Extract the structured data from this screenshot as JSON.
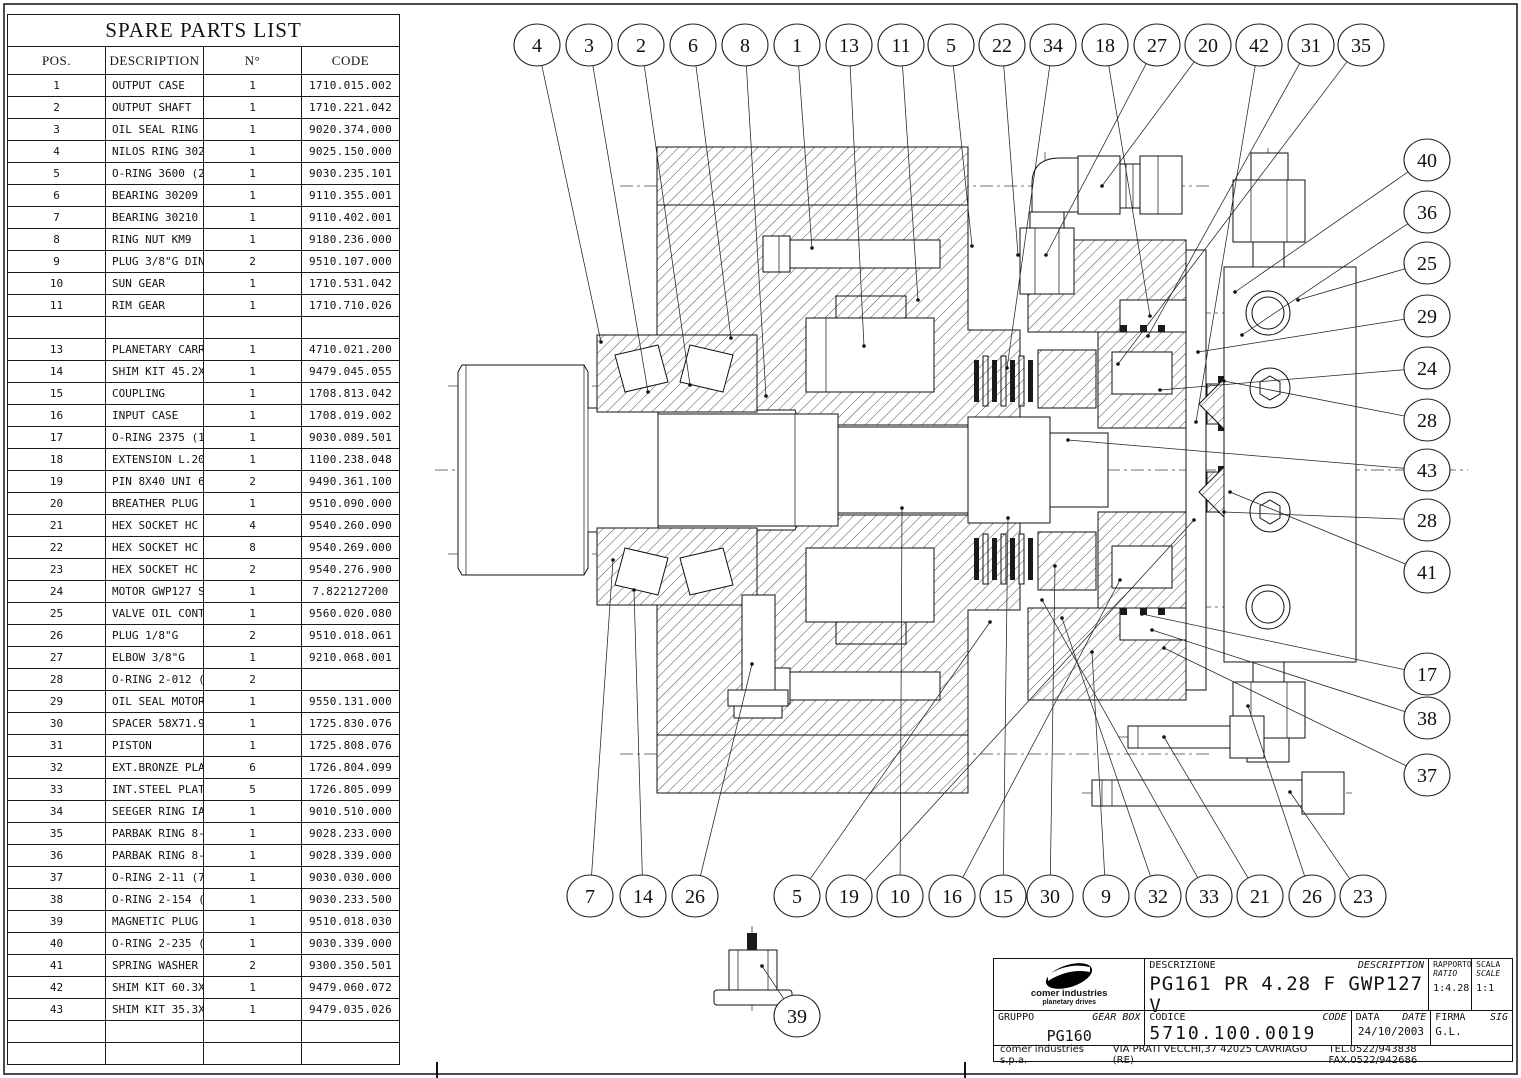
{
  "table": {
    "title": "SPARE PARTS LIST",
    "columns": [
      "POS.",
      "DESCRIPTION",
      "N°",
      "CODE"
    ],
    "rows": [
      {
        "pos": "1",
        "desc": "OUTPUT CASE",
        "qty": "1",
        "code": "1710.015.002"
      },
      {
        "pos": "2",
        "desc": "OUTPUT SHAFT",
        "qty": "1",
        "code": "1710.221.042"
      },
      {
        "pos": "3",
        "desc": "OIL SEAL RING 50X72X8 BA",
        "qty": "1",
        "code": "9020.374.000"
      },
      {
        "pos": "4",
        "desc": "NILOS RING 30210 AV",
        "qty": "1",
        "code": "9025.150.000"
      },
      {
        "pos": "5",
        "desc": "O-RING 3600 (2.62X152.7)",
        "qty": "1",
        "code": "9030.235.101"
      },
      {
        "pos": "6",
        "desc": "BEARING 30209 45X85X20.75",
        "qty": "1",
        "code": "9110.355.001"
      },
      {
        "pos": "7",
        "desc": "BEARING 30210 50X90X21.75",
        "qty": "1",
        "code": "9110.402.001"
      },
      {
        "pos": "8",
        "desc": "RING NUT KM9",
        "qty": "1",
        "code": "9180.236.000"
      },
      {
        "pos": "9",
        "desc": "PLUG 3/8\"G DIN 908",
        "qty": "2",
        "code": "9510.107.000"
      },
      {
        "pos": "10",
        "desc": "SUN GEAR",
        "qty": "1",
        "code": "1710.531.042"
      },
      {
        "pos": "11",
        "desc": "RIM GEAR",
        "qty": "1",
        "code": "1710.710.026"
      },
      {
        "pos": "",
        "desc": "",
        "qty": "",
        "code": ""
      },
      {
        "pos": "13",
        "desc": "PLANETARY CARRYER ASSEMBLED",
        "qty": "1",
        "code": "4710.021.200"
      },
      {
        "pos": "14",
        "desc": "SHIM KIT 45.2X54.2",
        "qty": "1",
        "code": "9479.045.055"
      },
      {
        "pos": "15",
        "desc": "COUPLING",
        "qty": "1",
        "code": "1708.813.042"
      },
      {
        "pos": "16",
        "desc": "INPUT CASE",
        "qty": "1",
        "code": "1708.019.002"
      },
      {
        "pos": "17",
        "desc": "O-RING 2375 (1.78X94.97)",
        "qty": "1",
        "code": "9030.089.501"
      },
      {
        "pos": "18",
        "desc": "EXTENSION L.20",
        "qty": "1",
        "code": "1100.238.048"
      },
      {
        "pos": "19",
        "desc": "PIN 8X40 UNI 6875",
        "qty": "2",
        "code": "9490.361.100"
      },
      {
        "pos": "20",
        "desc": "BREATHER PLUG 3/8\"G",
        "qty": "1",
        "code": "9510.090.000"
      },
      {
        "pos": "21",
        "desc": "HEX SOCKET HC SCREWS M8X40 UNI5931",
        "qty": "4",
        "code": "9540.260.090"
      },
      {
        "pos": "22",
        "desc": "HEX SOCKET HC SCREWS M8X65 UNI5931",
        "qty": "8",
        "code": "9540.269.000"
      },
      {
        "pos": "23",
        "desc": "HEX SOCKET HC SCREWS M8X80 UNI5931",
        "qty": "2",
        "code": "9540.276.900"
      },
      {
        "pos": "24",
        "desc": "MOTOR GWP127 S.O.",
        "qty": "1",
        "code": "7.822127200"
      },
      {
        "pos": "25",
        "desc": "VALVE OIL CONTROL",
        "qty": "1",
        "code": "9560.020.080"
      },
      {
        "pos": "26",
        "desc": "PLUG 1/8\"G",
        "qty": "2",
        "code": "9510.018.061"
      },
      {
        "pos": "27",
        "desc": "ELBOW 3/8\"G",
        "qty": "1",
        "code": "9210.068.001"
      },
      {
        "pos": "28",
        "desc": "O-RING 2-012 (1.78X9.25) 90 SHORE",
        "qty": "2",
        "code": ""
      },
      {
        "pos": "29",
        "desc": "OIL SEAL MOTOR'S KIT",
        "qty": "1",
        "code": "9550.131.000"
      },
      {
        "pos": "30",
        "desc": "SPACER 58X71.9X2",
        "qty": "1",
        "code": "1725.830.076"
      },
      {
        "pos": "31",
        "desc": "PISTON",
        "qty": "1",
        "code": "1725.808.076"
      },
      {
        "pos": "32",
        "desc": "EXT.BRONZE PLATE",
        "qty": "6",
        "code": "1726.804.099"
      },
      {
        "pos": "33",
        "desc": "INT.STEEL PLATE",
        "qty": "5",
        "code": "1726.805.099"
      },
      {
        "pos": "34",
        "desc": "SEEGER RING IA 72 UNI 7437",
        "qty": "1",
        "code": "9010.510.000"
      },
      {
        "pos": "35",
        "desc": "PARBAK RING 8-154",
        "qty": "1",
        "code": "9028.233.000"
      },
      {
        "pos": "36",
        "desc": "PARBAK RING 8-235",
        "qty": "1",
        "code": "9028.339.000"
      },
      {
        "pos": "37",
        "desc": "O-RING 2-11 (7.65X1.78)",
        "qty": "1",
        "code": "9030.030.000"
      },
      {
        "pos": "38",
        "desc": "O-RING 2-154 (2.62X94.92)",
        "qty": "1",
        "code": "9030.233.500"
      },
      {
        "pos": "39",
        "desc": "MAGNETIC PLUG 1/8",
        "qty": "1",
        "code": "9510.018.030"
      },
      {
        "pos": "40",
        "desc": "O-RING 2-235 (3.53X78.97)",
        "qty": "1",
        "code": "9030.339.000"
      },
      {
        "pos": "41",
        "desc": "SPRING WASHER 71X36X2",
        "qty": "2",
        "code": "9300.350.501"
      },
      {
        "pos": "42",
        "desc": "SHIM KIT 60.3X71.7",
        "qty": "1",
        "code": "9479.060.072"
      },
      {
        "pos": "43",
        "desc": "SHIM KIT 35.3X26.3",
        "qty": "1",
        "code": "9479.035.026"
      },
      {
        "pos": "",
        "desc": "",
        "qty": "",
        "code": ""
      },
      {
        "pos": "",
        "desc": "",
        "qty": "",
        "code": ""
      }
    ]
  },
  "title_block": {
    "logo_line1": "comer industries",
    "logo_line2": "planetary drives",
    "descrizione_label": "DESCRIZIONE",
    "description_label": "DESCRIPTION",
    "description_value": "PG161 PR 4.28 F GWP127 V",
    "rapporto_label": "RAPPORTO",
    "ratio_label": "RATIO",
    "ratio_value": "1:4.28",
    "scala_label": "SCALA",
    "scale_label": "SCALE",
    "scale_value": "1:1",
    "gruppo_label": "GRUPPO",
    "gearbox_label": "GEAR BOX",
    "gruppo_value": "PG160",
    "codice_label": "CODICE",
    "code_label": "CODE",
    "codice_value": "5710.100.0019",
    "data_label": "DATA",
    "date_label": "DATE",
    "data_value": "24/10/2003",
    "firma_label": "FIRMA",
    "sig_label": "SIG",
    "firma_value": "G.L.",
    "footer_company": "comer industries s.p.a.",
    "footer_address": "VIA PRATI VECCHI,37 42025 CAVRIAGO (RE)",
    "footer_phone": "TEL.0522/943838 FAX.0522/942686"
  },
  "balloons": [
    {
      "n": "4",
      "x": 537,
      "y": 45,
      "tx": 601,
      "ty": 342
    },
    {
      "n": "3",
      "x": 589,
      "y": 45,
      "tx": 648,
      "ty": 392
    },
    {
      "n": "2",
      "x": 641,
      "y": 45,
      "tx": 690,
      "ty": 385
    },
    {
      "n": "6",
      "x": 693,
      "y": 45,
      "tx": 731,
      "ty": 338
    },
    {
      "n": "8",
      "x": 745,
      "y": 45,
      "tx": 766,
      "ty": 396
    },
    {
      "n": "1",
      "x": 797,
      "y": 45,
      "tx": 812,
      "ty": 248
    },
    {
      "n": "13",
      "x": 849,
      "y": 45,
      "tx": 864,
      "ty": 346
    },
    {
      "n": "11",
      "x": 901,
      "y": 45,
      "tx": 918,
      "ty": 300
    },
    {
      "n": "5",
      "x": 951,
      "y": 45,
      "tx": 972,
      "ty": 246
    },
    {
      "n": "22",
      "x": 1002,
      "y": 45,
      "tx": 1018,
      "ty": 255
    },
    {
      "n": "34",
      "x": 1053,
      "y": 45,
      "tx": 1007,
      "ty": 368
    },
    {
      "n": "18",
      "x": 1105,
      "y": 45,
      "tx": 1150,
      "ty": 316
    },
    {
      "n": "27",
      "x": 1157,
      "y": 45,
      "tx": 1046,
      "ty": 255
    },
    {
      "n": "20",
      "x": 1208,
      "y": 45,
      "tx": 1102,
      "ty": 186
    },
    {
      "n": "42",
      "x": 1259,
      "y": 45,
      "tx": 1196,
      "ty": 422
    },
    {
      "n": "31",
      "x": 1311,
      "y": 45,
      "tx": 1148,
      "ty": 336
    },
    {
      "n": "35",
      "x": 1361,
      "y": 45,
      "tx": 1118,
      "ty": 364
    },
    {
      "n": "40",
      "x": 1427,
      "y": 160,
      "tx": 1235,
      "ty": 292
    },
    {
      "n": "36",
      "x": 1427,
      "y": 212,
      "tx": 1242,
      "ty": 335
    },
    {
      "n": "25",
      "x": 1427,
      "y": 263,
      "tx": 1298,
      "ty": 300
    },
    {
      "n": "29",
      "x": 1427,
      "y": 316,
      "tx": 1198,
      "ty": 352
    },
    {
      "n": "24",
      "x": 1427,
      "y": 368,
      "tx": 1160,
      "ty": 390
    },
    {
      "n": "28",
      "x": 1427,
      "y": 420,
      "tx": 1224,
      "ty": 381
    },
    {
      "n": "43",
      "x": 1427,
      "y": 470,
      "tx": 1068,
      "ty": 440
    },
    {
      "n": "28",
      "x": 1427,
      "y": 520,
      "tx": 1224,
      "ty": 512
    },
    {
      "n": "41",
      "x": 1427,
      "y": 572,
      "tx": 1230,
      "ty": 492
    },
    {
      "n": "17",
      "x": 1427,
      "y": 674,
      "tx": 1142,
      "ty": 614
    },
    {
      "n": "38",
      "x": 1427,
      "y": 718,
      "tx": 1152,
      "ty": 630
    },
    {
      "n": "37",
      "x": 1427,
      "y": 775,
      "tx": 1164,
      "ty": 648
    },
    {
      "n": "7",
      "x": 590,
      "y": 896,
      "tx": 613,
      "ty": 560
    },
    {
      "n": "14",
      "x": 643,
      "y": 896,
      "tx": 634,
      "ty": 590
    },
    {
      "n": "26",
      "x": 695,
      "y": 896,
      "tx": 752,
      "ty": 664
    },
    {
      "n": "5",
      "x": 797,
      "y": 896,
      "tx": 990,
      "ty": 622
    },
    {
      "n": "19",
      "x": 849,
      "y": 896,
      "tx": 1194,
      "ty": 520
    },
    {
      "n": "10",
      "x": 900,
      "y": 896,
      "tx": 902,
      "ty": 508
    },
    {
      "n": "16",
      "x": 952,
      "y": 896,
      "tx": 1120,
      "ty": 580
    },
    {
      "n": "15",
      "x": 1003,
      "y": 896,
      "tx": 1008,
      "ty": 518
    },
    {
      "n": "30",
      "x": 1050,
      "y": 896,
      "tx": 1055,
      "ty": 566
    },
    {
      "n": "9",
      "x": 1106,
      "y": 896,
      "tx": 1092,
      "ty": 652
    },
    {
      "n": "32",
      "x": 1158,
      "y": 896,
      "tx": 1062,
      "ty": 618
    },
    {
      "n": "33",
      "x": 1209,
      "y": 896,
      "tx": 1042,
      "ty": 600
    },
    {
      "n": "21",
      "x": 1260,
      "y": 896,
      "tx": 1164,
      "ty": 737
    },
    {
      "n": "26",
      "x": 1312,
      "y": 896,
      "tx": 1248,
      "ty": 706
    },
    {
      "n": "23",
      "x": 1363,
      "y": 896,
      "tx": 1290,
      "ty": 792
    },
    {
      "n": "39",
      "x": 797,
      "y": 1016,
      "tx": 762,
      "ty": 966
    }
  ]
}
